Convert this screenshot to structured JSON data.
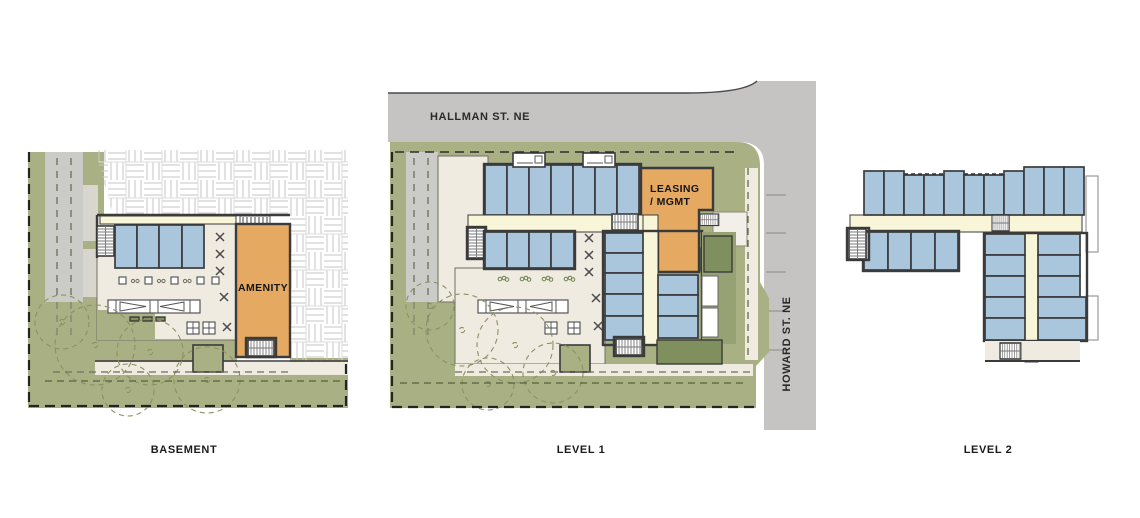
{
  "sheet": {
    "type_note": "architectural site / floor plan sheet"
  },
  "panels": {
    "basement": {
      "title": "BASEMENT",
      "amenity_label": "AMENITY",
      "north_row_units": 4
    },
    "level1": {
      "title": "LEVEL 1",
      "leasing_label_line1": "LEASING",
      "leasing_label_line2": "/ MGMT",
      "street_north": "HALLMAN ST. NE",
      "street_east": "HOWARD ST. NE",
      "north_row_units": 7,
      "south_row_units": 4,
      "east_wing_units": 8
    },
    "level2": {
      "title": "LEVEL 2",
      "north_row_units": 11,
      "south_row_units": 4,
      "wing_units": 10
    }
  },
  "colors": {
    "landscape_green": "#a9b184",
    "strip_green": "#96a274",
    "shrub_green": "#7f8f5d",
    "street_gray": "#c5c4c2",
    "driveway_gray": "#cbcbc8",
    "pad_gray": "#d8d6cf",
    "floor_beige": "#efebe1",
    "corridor_cream": "#f9f5d8",
    "unit_blue": "#a9c6dd",
    "room_orange": "#e5a961",
    "wall_dark": "#3b3b3b",
    "hatch_line": "#c6c6c6",
    "tree_olive": "#8a9163",
    "text_black": "#1b1b1b"
  }
}
